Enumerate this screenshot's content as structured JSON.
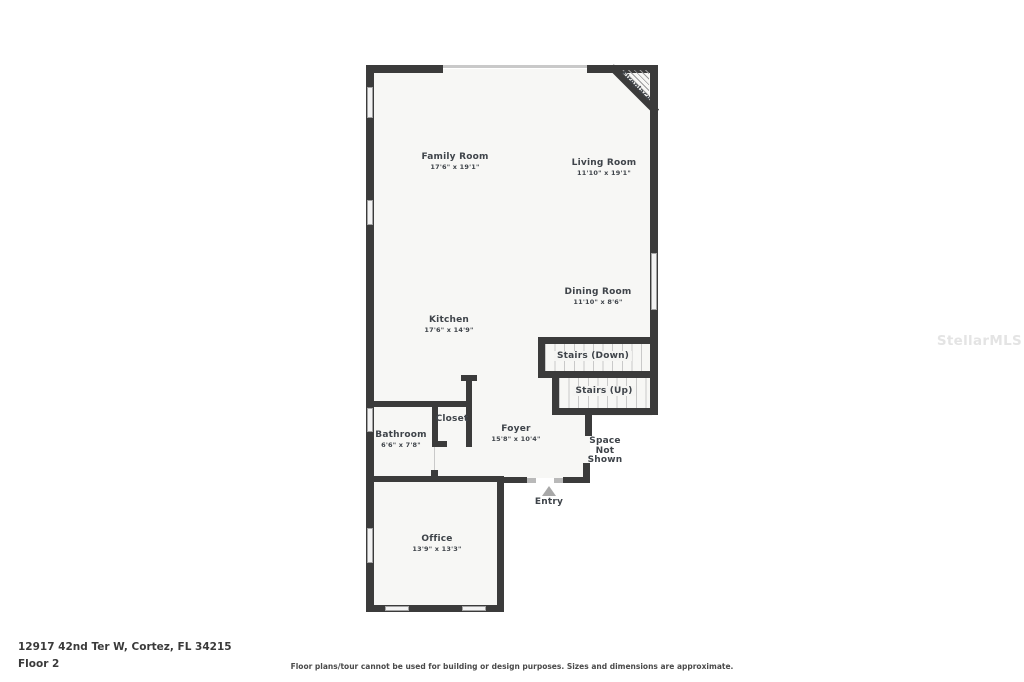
{
  "watermark": "StellarMLS",
  "footer": {
    "address": "12917 42nd Ter W, Cortez, FL 34215",
    "floor_label": "Floor 2",
    "disclaimer": "Floor plans/tour cannot be used for building or design purposes. Sizes and dimensions are approximate."
  },
  "rooms": [
    {
      "id": "family-room",
      "name": "Family Room",
      "dims": "17'6\" x 19'1\""
    },
    {
      "id": "living-room",
      "name": "Living Room",
      "dims": "11'10\" x 19'1\""
    },
    {
      "id": "dining-room",
      "name": "Dining Room",
      "dims": "11'10\" x 8'6\""
    },
    {
      "id": "kitchen",
      "name": "Kitchen",
      "dims": "17'6\" x 14'9\""
    },
    {
      "id": "stairs-down",
      "name": "Stairs (Down)"
    },
    {
      "id": "stairs-up",
      "name": "Stairs (Up)"
    },
    {
      "id": "closet",
      "name": "Closet"
    },
    {
      "id": "bathroom",
      "name": "Bathroom",
      "dims": "6'6\" x 7'8\""
    },
    {
      "id": "foyer",
      "name": "Foyer",
      "dims": "15'8\" x 10'4\""
    },
    {
      "id": "space-not-shown",
      "name": "Space Not Shown",
      "lines": [
        "Space",
        "Not",
        "Shown"
      ]
    },
    {
      "id": "entry",
      "name": "Entry"
    },
    {
      "id": "office",
      "name": "Office",
      "dims": "13'9\" x 13'3\""
    },
    {
      "id": "fireplace",
      "name": "Fireplace"
    }
  ],
  "colors": {
    "wall": "#3b3b3b",
    "floor": "#f7f7f5",
    "label_text": "#3f444a",
    "window": "#f2f2f2",
    "entry_arrow": "#a8a8a8",
    "watermark": "#e4e4e4"
  }
}
